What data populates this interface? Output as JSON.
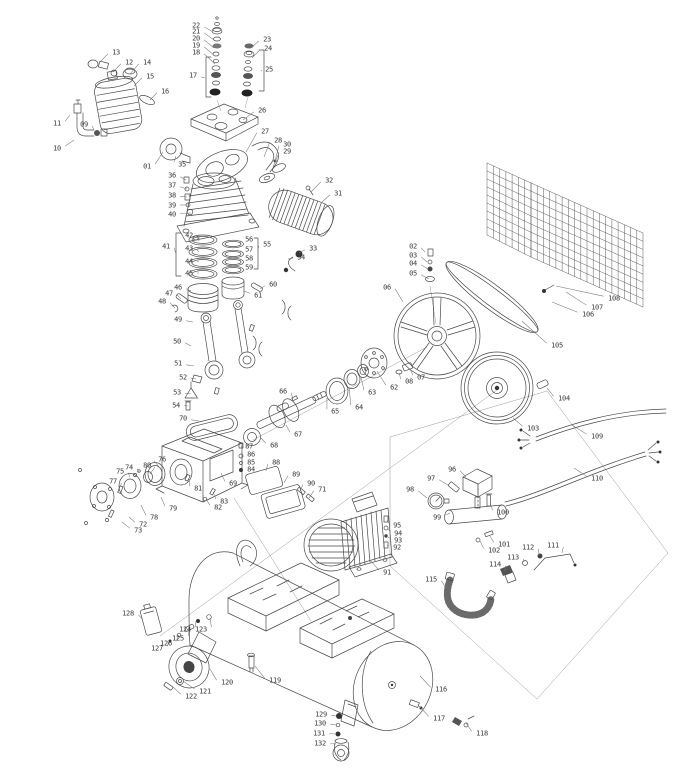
{
  "diagram": {
    "alt": "exploded-parts-diagram-air-compressor",
    "colors": {
      "background": "#ffffff",
      "line": "#4a4a4a",
      "label": "#3a3a3a",
      "leader": "#787878",
      "construction": "#9a9a9a"
    },
    "labels": [
      [
        "13",
        116,
        52,
        100,
        62
      ],
      [
        "12",
        129,
        62,
        113,
        72
      ],
      [
        "14",
        147,
        62,
        130,
        74
      ],
      [
        "15",
        150,
        76,
        134,
        86
      ],
      [
        "16",
        165,
        91,
        150,
        100
      ],
      [
        "11",
        57,
        123,
        70,
        115
      ],
      [
        "09",
        84,
        124,
        94,
        130
      ],
      [
        "10",
        57,
        148,
        74,
        140
      ],
      [
        "01",
        147,
        166,
        163,
        152
      ],
      [
        "35",
        182,
        164,
        176,
        156
      ],
      [
        "22",
        196,
        25,
        213,
        32
      ],
      [
        "21",
        196,
        31,
        214,
        40
      ],
      [
        "20",
        196,
        38,
        214,
        48
      ],
      [
        "19",
        196,
        45,
        215,
        56
      ],
      [
        "18",
        196,
        52,
        215,
        64
      ],
      [
        "23",
        267,
        39,
        251,
        48
      ],
      [
        "24",
        268,
        48,
        252,
        58
      ],
      [
        "17",
        193,
        75,
        205,
        78
      ],
      [
        "25",
        269,
        69,
        262,
        71
      ],
      [
        "26",
        262,
        110,
        243,
        120
      ],
      [
        "27",
        265,
        131,
        246,
        152
      ],
      [
        "28",
        278,
        140,
        264,
        157
      ],
      [
        "30",
        287,
        144,
        275,
        161
      ],
      [
        "29",
        287,
        151,
        273,
        167
      ],
      [
        "36",
        172,
        175,
        186,
        180
      ],
      [
        "37",
        172,
        185,
        187,
        189
      ],
      [
        "38",
        172,
        195,
        187,
        197
      ],
      [
        "39",
        172,
        205,
        188,
        205
      ],
      [
        "40",
        172,
        214,
        191,
        213
      ],
      [
        "32",
        329,
        180,
        311,
        192
      ],
      [
        "31",
        338,
        193,
        322,
        202
      ],
      [
        "33",
        313,
        248,
        299,
        253
      ],
      [
        "34",
        301,
        257,
        288,
        259
      ],
      [
        "41",
        166,
        246,
        176,
        254
      ],
      [
        "42",
        189,
        235,
        199,
        241
      ],
      [
        "43",
        189,
        248,
        199,
        252
      ],
      [
        "44",
        189,
        261,
        199,
        262
      ],
      [
        "45",
        189,
        273,
        199,
        273
      ],
      [
        "46",
        178,
        287,
        191,
        291
      ],
      [
        "47",
        169,
        293,
        181,
        299
      ],
      [
        "48",
        162,
        301,
        175,
        308
      ],
      [
        "49",
        178,
        319,
        193,
        322
      ],
      [
        "55",
        267,
        244,
        258,
        250
      ],
      [
        "56",
        249,
        239,
        240,
        244
      ],
      [
        "57",
        249,
        249,
        240,
        253
      ],
      [
        "58",
        249,
        258,
        240,
        261
      ],
      [
        "59",
        249,
        267,
        240,
        269
      ],
      [
        "60",
        273,
        284,
        260,
        289
      ],
      [
        "61",
        258,
        295,
        244,
        291
      ],
      [
        "50",
        177,
        341,
        191,
        346
      ],
      [
        "51",
        178,
        363,
        194,
        366
      ],
      [
        "52",
        183,
        377,
        196,
        379
      ],
      [
        "53",
        177,
        392,
        191,
        394
      ],
      [
        "54",
        176,
        405,
        188,
        406
      ],
      [
        "70",
        183,
        418,
        199,
        421
      ],
      [
        "66",
        283,
        391,
        293,
        399
      ],
      [
        "65",
        335,
        411,
        327,
        398
      ],
      [
        "64",
        359,
        407,
        349,
        387
      ],
      [
        "63",
        372,
        392,
        361,
        377
      ],
      [
        "62",
        394,
        387,
        377,
        371
      ],
      [
        "08",
        409,
        381,
        399,
        373
      ],
      [
        "07",
        421,
        377,
        410,
        369
      ],
      [
        "67",
        298,
        434,
        286,
        425
      ],
      [
        "68",
        274,
        445,
        261,
        438
      ],
      [
        "69",
        233,
        483,
        221,
        473
      ],
      [
        "74",
        129,
        467,
        139,
        472
      ],
      [
        "75",
        120,
        471,
        130,
        477
      ],
      [
        "76",
        162,
        459,
        160,
        468
      ],
      [
        "80",
        147,
        465,
        150,
        474
      ],
      [
        "77",
        113,
        481,
        121,
        487
      ],
      [
        "79",
        173,
        508,
        161,
        497
      ],
      [
        "78",
        154,
        517,
        141,
        505
      ],
      [
        "72",
        143,
        524,
        129,
        517
      ],
      [
        "73",
        138,
        530,
        122,
        522
      ],
      [
        "81",
        198,
        488,
        189,
        479
      ],
      [
        "83",
        224,
        501,
        213,
        492
      ],
      [
        "82",
        218,
        507,
        206,
        499
      ],
      [
        "87",
        249,
        446,
        242,
        447
      ],
      [
        "86",
        251,
        454,
        242,
        456
      ],
      [
        "85",
        251,
        462,
        242,
        463
      ],
      [
        "84",
        251,
        469,
        242,
        470
      ],
      [
        "88",
        276,
        462,
        266,
        471
      ],
      [
        "89",
        296,
        474,
        284,
        483
      ],
      [
        "90",
        311,
        483,
        300,
        491
      ],
      [
        "71",
        322,
        489,
        309,
        498
      ],
      [
        "02",
        413,
        246,
        425,
        252
      ],
      [
        "03",
        413,
        255,
        427,
        262
      ],
      [
        "04",
        413,
        263,
        428,
        269
      ],
      [
        "05",
        413,
        273,
        429,
        279
      ],
      [
        "06",
        387,
        287,
        403,
        302
      ],
      [
        "105",
        557,
        345,
        522,
        321
      ],
      [
        "106",
        588,
        314,
        552,
        302
      ],
      [
        "107",
        597,
        307,
        566,
        292
      ],
      [
        "108",
        614,
        298,
        556,
        286
      ],
      [
        "104",
        564,
        398,
        547,
        388
      ],
      [
        "103",
        533,
        428,
        513,
        418
      ],
      [
        "109",
        597,
        436,
        572,
        425
      ],
      [
        "110",
        597,
        478,
        574,
        468
      ],
      [
        "95",
        397,
        525,
        387,
        520
      ],
      [
        "94",
        398,
        533,
        388,
        529
      ],
      [
        "93",
        398,
        540,
        388,
        537
      ],
      [
        "92",
        397,
        547,
        387,
        545
      ],
      [
        "91",
        387,
        572,
        371,
        561
      ],
      [
        "96",
        452,
        469,
        466,
        477
      ],
      [
        "97",
        431,
        478,
        448,
        485
      ],
      [
        "98",
        410,
        489,
        427,
        498
      ],
      [
        "99",
        437,
        517,
        450,
        513
      ],
      [
        "100",
        503,
        512,
        490,
        503
      ],
      [
        "101",
        504,
        544,
        490,
        536
      ],
      [
        "102",
        494,
        550,
        480,
        541
      ],
      [
        "112",
        528,
        547,
        539,
        555
      ],
      [
        "111",
        553,
        545,
        562,
        553
      ],
      [
        "113",
        513,
        557,
        524,
        562
      ],
      [
        "114",
        495,
        564,
        505,
        571
      ],
      [
        "115",
        431,
        579,
        446,
        588
      ],
      [
        "128",
        128,
        613,
        143,
        620
      ],
      [
        "124",
        185,
        629,
        196,
        621
      ],
      [
        "123",
        201,
        629,
        210,
        618
      ],
      [
        "125",
        178,
        638,
        189,
        629
      ],
      [
        "126",
        166,
        643,
        178,
        635
      ],
      [
        "127",
        157,
        648,
        169,
        641
      ],
      [
        "120",
        227,
        682,
        210,
        669
      ],
      [
        "121",
        205,
        691,
        183,
        681
      ],
      [
        "122",
        191,
        696,
        173,
        687
      ],
      [
        "119",
        275,
        680,
        255,
        666
      ],
      [
        "116",
        441,
        689,
        420,
        676
      ],
      [
        "117",
        439,
        718,
        419,
        706
      ],
      [
        "118",
        482,
        733,
        466,
        723
      ],
      [
        "129",
        321,
        714,
        336,
        716
      ],
      [
        "130",
        320,
        723,
        336,
        725
      ],
      [
        "131",
        319,
        733,
        335,
        734
      ],
      [
        "132",
        320,
        743,
        336,
        744
      ]
    ]
  }
}
